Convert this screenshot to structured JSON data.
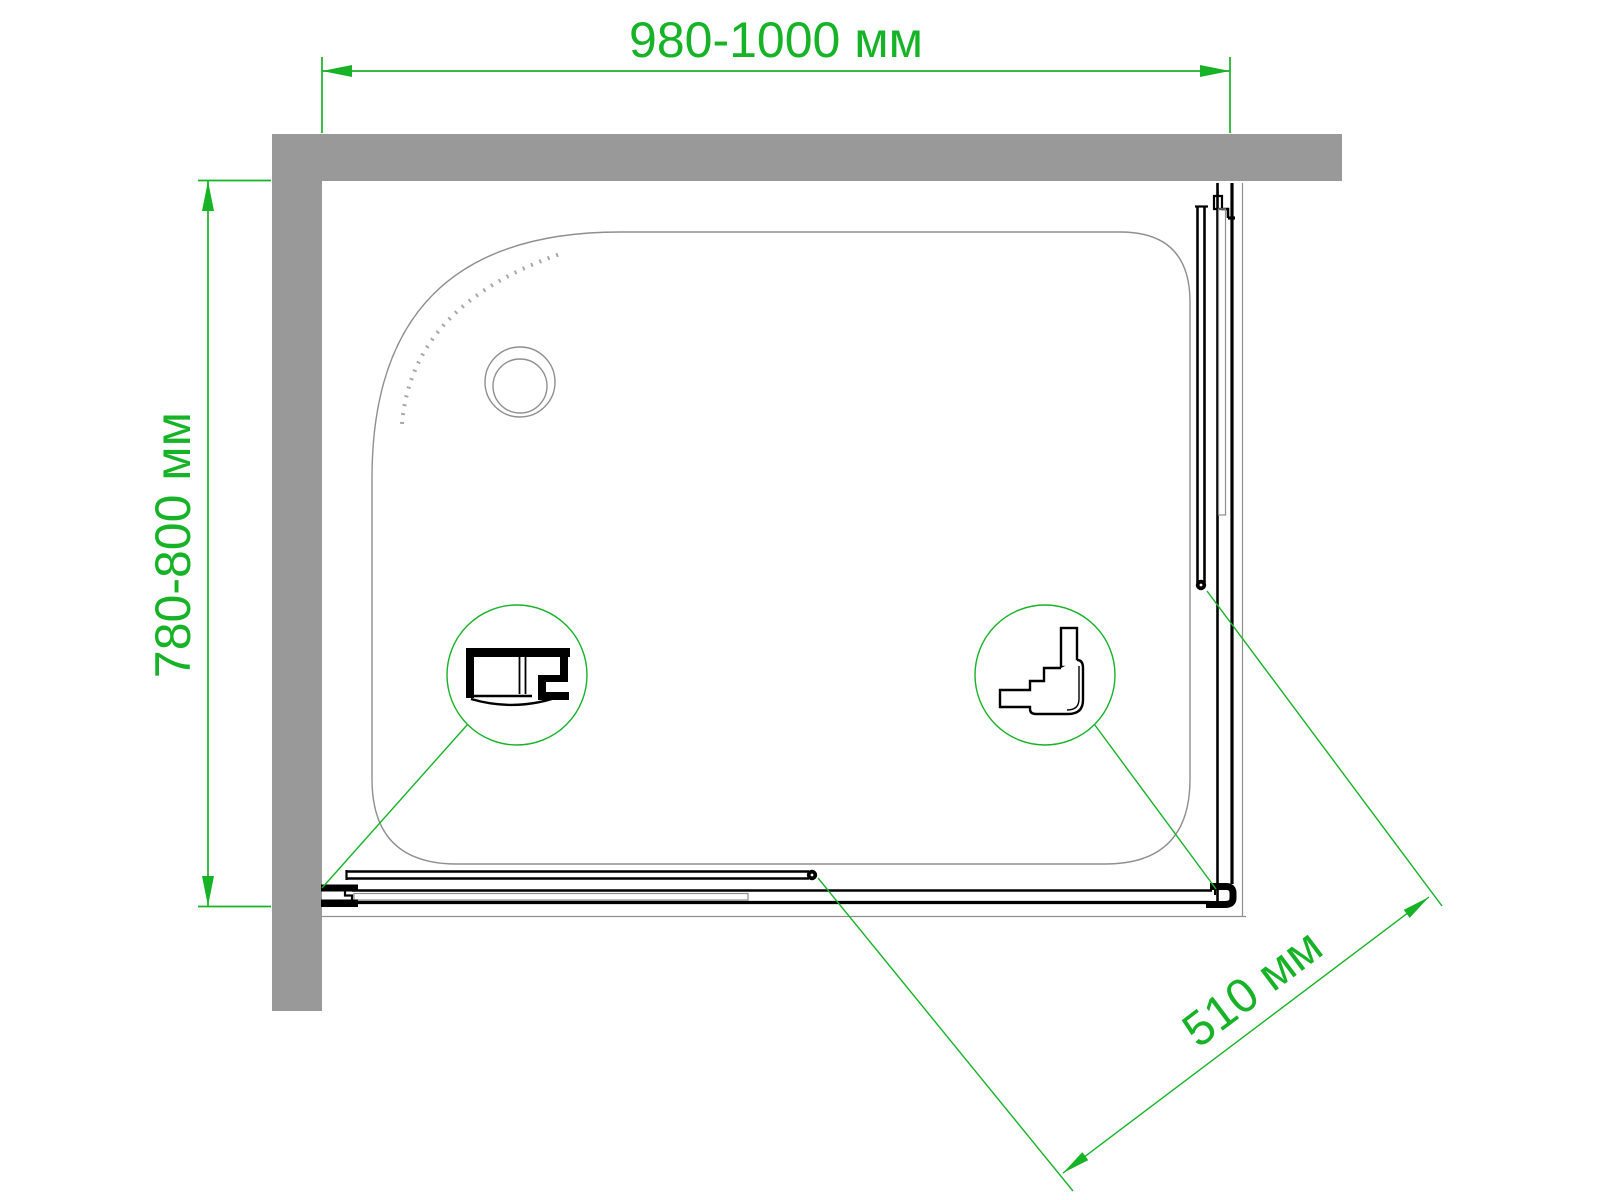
{
  "drawing": {
    "dimensions": {
      "width_label": "980-1000 мм",
      "depth_label": "780-800 мм",
      "entry_label": "510 мм"
    },
    "colors": {
      "dimension_green": "#17b327",
      "wall_gray": "#999999",
      "tray_line_gray": "#8f8f8f",
      "profile_black": "#000000"
    }
  }
}
